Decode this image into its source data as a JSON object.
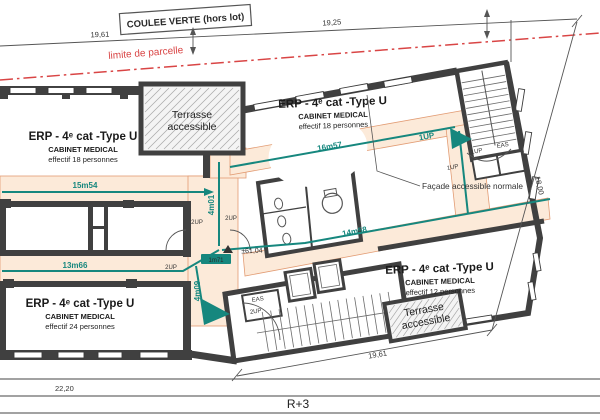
{
  "plan": {
    "level_label": "R+3",
    "site": {
      "green_corridor": "COULEE VERTE (hors lot)",
      "parcel_limit": "limite de parcelle"
    },
    "units": {
      "top_left": {
        "title": "ERP - 4ᵉ cat -Type U",
        "category": "CABINET MEDICAL",
        "occupancy": "effectif 18 personnes"
      },
      "top_right": {
        "title": "ERP - 4ᵉ cat -Type U",
        "category": "CABINET MEDICAL",
        "occupancy": "effectif 18 personnes"
      },
      "bottom_left": {
        "title": "ERP - 4ᵉ cat -Type U",
        "category": "CABINET MEDICAL",
        "occupancy": "effectif 24 personnes"
      },
      "bottom_right": {
        "title": "ERP - 4ᵉ cat -Type U",
        "category": "CABINET MEDICAL",
        "occupancy": "effectif 12 personnes"
      }
    },
    "terrace": {
      "line1": "Terrasse",
      "line2": "accessible"
    },
    "notes": {
      "facade": "Façade accessible normale"
    },
    "level_marker": {
      "altitude": "±61,04",
      "height": "1m71"
    },
    "evacuation": {
      "d_top_left": "15m54",
      "d_bottom_left": "13m66",
      "d_top_right": "16m57",
      "d_bottom_right": "14m58",
      "v_center": "4m01",
      "v_lower": "4m09",
      "exit_top": "1UP"
    },
    "doors": {
      "two_up": "2UP",
      "one_up": "1UP",
      "eas": "EAS"
    },
    "dimensions": {
      "top_left": "19,61",
      "top_right": "19,25",
      "bottom_left": "22,20",
      "bottom_right": "19,61",
      "right_side": "18,00"
    },
    "colors": {
      "evac_teal": "#16877e",
      "corridor_peach": "#fcead9",
      "parcel_red": "#d94545",
      "wall_gray": "#404040"
    }
  }
}
